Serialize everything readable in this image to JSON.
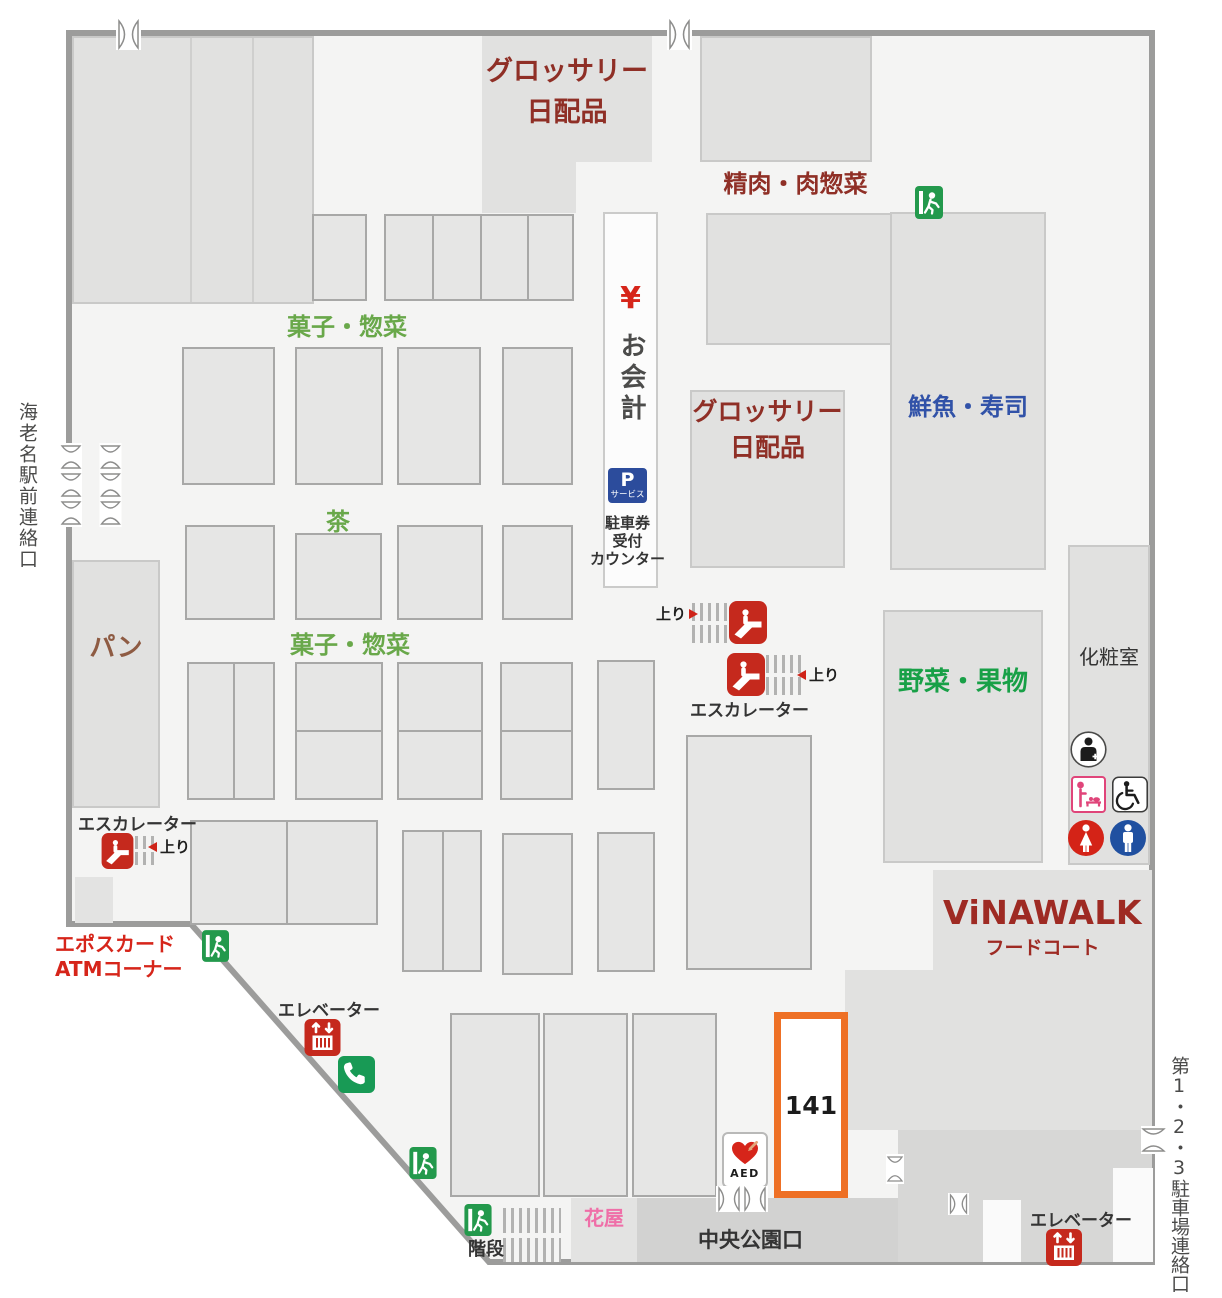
{
  "departments": {
    "grocery_daily_top": "グロッサリー\n日配品",
    "meat_deli": "精肉・肉惣菜",
    "sweets_deli_upper": "菓子・惣菜",
    "tea": "茶",
    "sweets_deli_lower": "菓子・惣菜",
    "bread": "パン",
    "grocery_daily_center": "グロッサリー\n日配品",
    "fresh_fish_sushi": "鮮魚・寿司",
    "vegetables_fruits": "野菜・果物",
    "flower_shop": "花屋"
  },
  "facilities": {
    "yen_mark": "¥",
    "checkout": "お会計",
    "parking_p": "P",
    "parking_p_sub": "サービス",
    "parking_counter": "駐車券\n受付\nカウンター",
    "escalator_upper": "エスカレーター",
    "escalator_lower_left": "エスカレーター",
    "up_1": "上り",
    "up_2": "上り",
    "up_3": "上り",
    "elevator_southwest": "エレベーター",
    "elevator_southeast": "エレベーター",
    "stairs": "階段",
    "restroom": "化粧室",
    "aed": "AED",
    "epos_atm": "エポスカード\nATMコーナー"
  },
  "food_court": {
    "brand": "ViNAWALK",
    "label": "フードコート"
  },
  "exits": {
    "station": "海老名駅前連絡口",
    "central_park": "中央公園口",
    "parking": "第1・2・3駐車場連絡口"
  },
  "highlighted_store": {
    "number": "141"
  },
  "icons": [
    "exit-icon",
    "escalator-icon",
    "elevator-icon",
    "phone-icon",
    "p-service-icon",
    "aed-icon",
    "nursing-room-icon",
    "baby-changing-icon",
    "wheelchair-icon",
    "womens-restroom-icon",
    "mens-restroom-icon",
    "door-icon"
  ],
  "colors": {
    "dept_maroon": "#8f2f26",
    "label_green": "#69a84a",
    "label_bright_green": "#18a047",
    "label_blue": "#3152a8",
    "label_brown": "#8e5b43",
    "label_red": "#d6251a",
    "label_pink": "#ef6fa8",
    "brand_red": "#9e2a23",
    "exit_green": "#23994c",
    "icon_red": "#c5291d",
    "phone_green": "#189a55",
    "parking_blue": "#2c4c9c",
    "highlight_orange": "#ee7025",
    "floor": "#f4f4f3",
    "wall": "#9c9c9b"
  }
}
